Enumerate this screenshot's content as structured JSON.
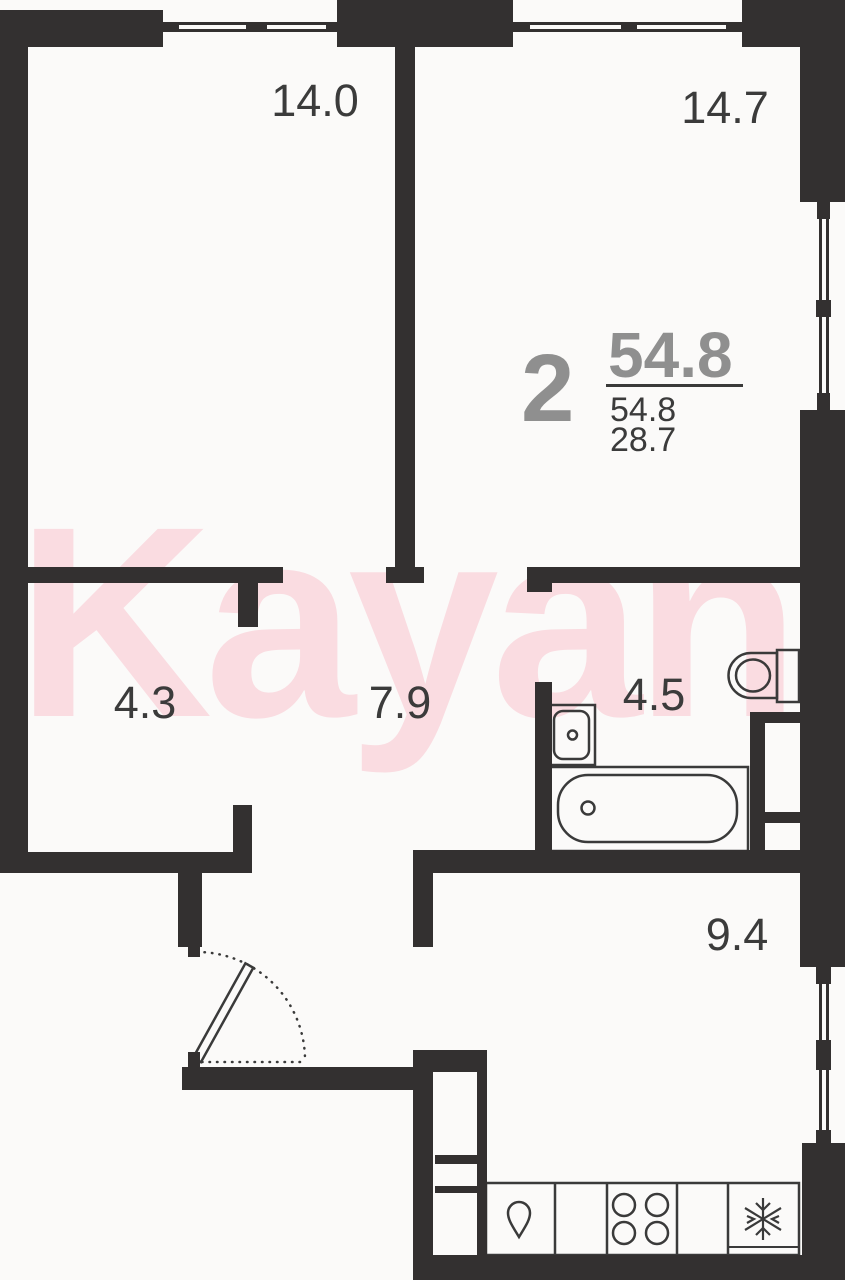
{
  "watermark": {
    "text": "Kayan",
    "color": "#FADCE1"
  },
  "summary": {
    "rooms_count": "2",
    "area_headline": "54.8",
    "area_total": "54.8",
    "area_living": "28.7"
  },
  "rooms": {
    "bedroom_left": "14.0",
    "bedroom_right": "14.7",
    "closet": "4.3",
    "hallway": "7.9",
    "bathroom": "4.5",
    "kitchen": "9.4"
  },
  "fixtures": {
    "toilet": "toilet",
    "bath_sink": "sink",
    "bathtub": "bathtub",
    "kitchen_sink": "drop-icon",
    "stove": "four-burner-stove",
    "fridge": "snowflake-icon",
    "entry_door": "door-swing"
  },
  "colors": {
    "wall": "#333030",
    "fixture_line": "#3A3A3A",
    "label_text": "#3B3B3B",
    "summary_gray": "#8F8F8F",
    "watermark_pink": "#FADCE1",
    "background": "#FBFAF9"
  }
}
